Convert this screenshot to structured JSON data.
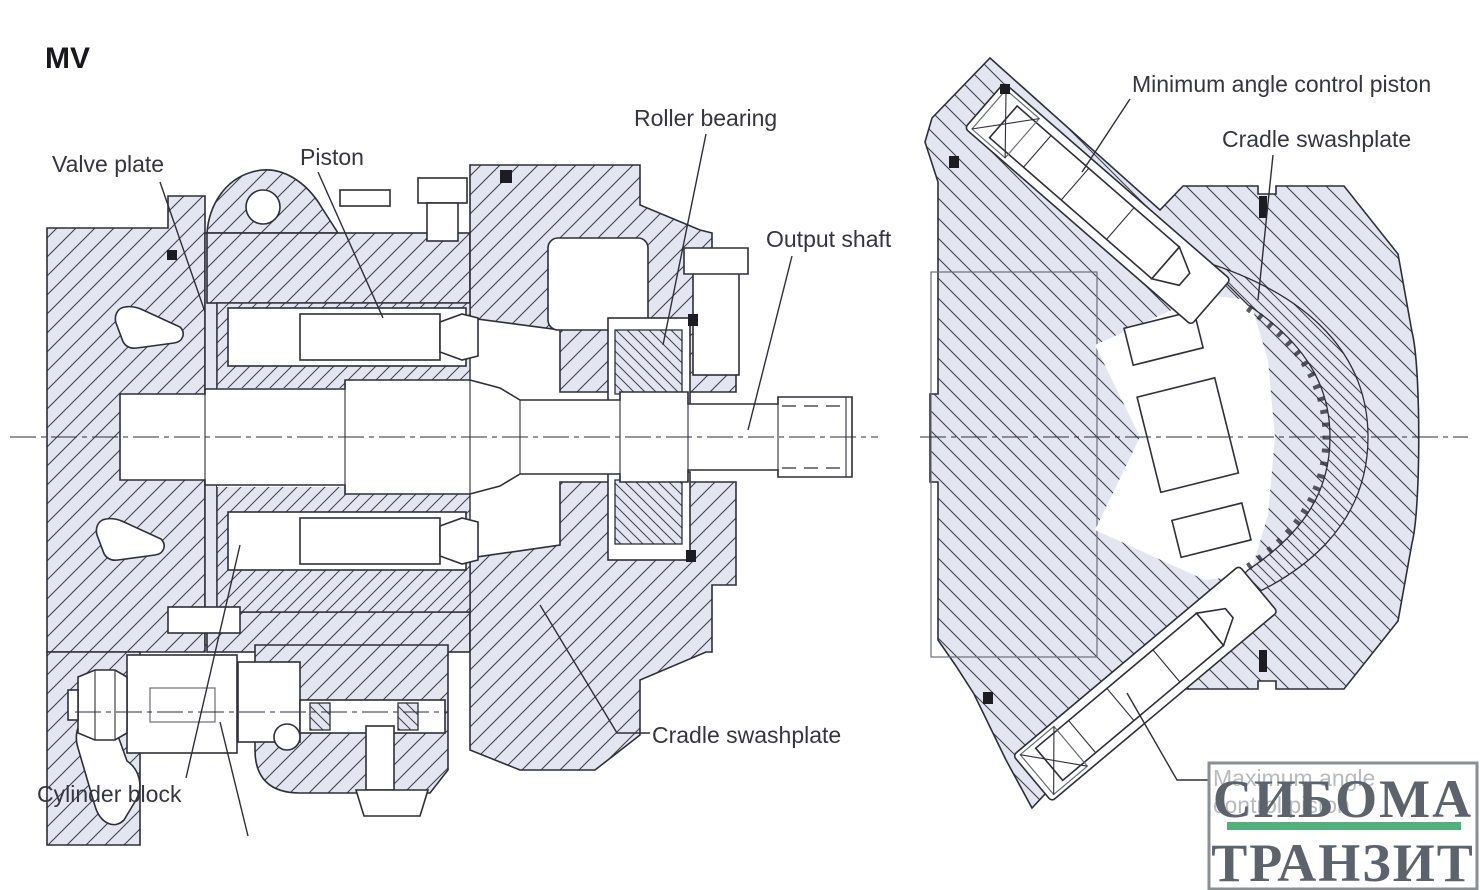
{
  "title": "MV",
  "labels": {
    "left_view": {
      "valve_plate": "Valve plate",
      "piston": "Piston",
      "roller_bearing": "Roller bearing",
      "output_shaft": "Output shaft",
      "cradle_swashplate": "Cradle swashplate",
      "cylinder_block": "Cylinder block"
    },
    "right_view": {
      "minimum_angle_control_piston": "Minimum angle control piston",
      "cradle_swashplate": "Cradle swashplate",
      "maximum_angle_line1": "Maximum angle",
      "maximum_angle_line2": "control piston"
    }
  },
  "watermark": {
    "line1": "СИБОМА",
    "line2": "ТРАНЗИТ"
  },
  "colors": {
    "section_fill": "#e3e5f1",
    "hatch_line": "#41414d",
    "line": "#2e2e38",
    "label_text": "#35353f",
    "muted_label": "#70757c",
    "watermark_text": "#5c636c",
    "watermark_green": "#52b07c",
    "watermark_border": "#8a8f96"
  }
}
